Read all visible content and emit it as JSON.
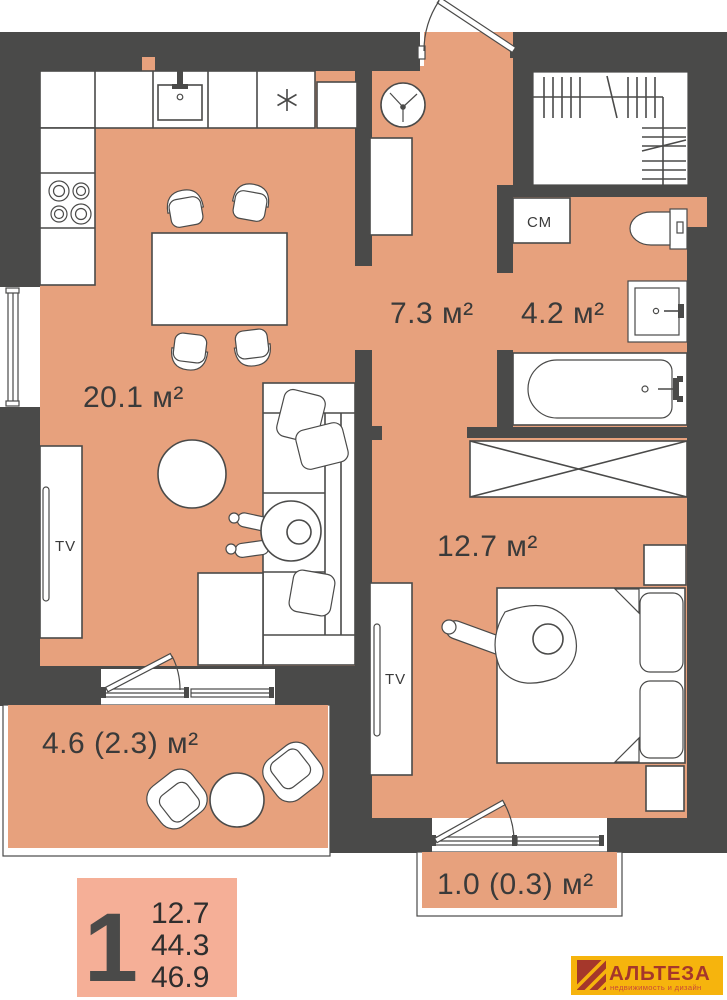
{
  "plan_type": "floor-plan",
  "rooms": [
    {
      "id": "kitchen-living",
      "label": "20.1 м²"
    },
    {
      "id": "hallway",
      "label": "7.3 м²"
    },
    {
      "id": "bathroom",
      "label": "4.2 м²"
    },
    {
      "id": "bedroom",
      "label": "12.7 м²"
    },
    {
      "id": "loggia-living",
      "label": "4.6 (2.3) м²"
    },
    {
      "id": "balcony-bedroom",
      "label": "1.0 (0.3) м²"
    }
  ],
  "fixtures": {
    "washing_machine": "СМ",
    "tv_living": "TV",
    "tv_bedroom": "TV"
  },
  "legend": {
    "rooms_count": "1",
    "values": [
      "12.7",
      "44.3",
      "46.9"
    ]
  },
  "logo": {
    "name": "АЛЬТЕЗА",
    "tagline": "недвижимость и дизайн"
  },
  "colors": {
    "floor": "#E7A17D",
    "wall": "#4A4A49",
    "legend_bg": "#F5AF97",
    "logo_bg": "#F6B40D",
    "logo_accent": "#A5372B",
    "logo_tagline": "#C9473A"
  }
}
